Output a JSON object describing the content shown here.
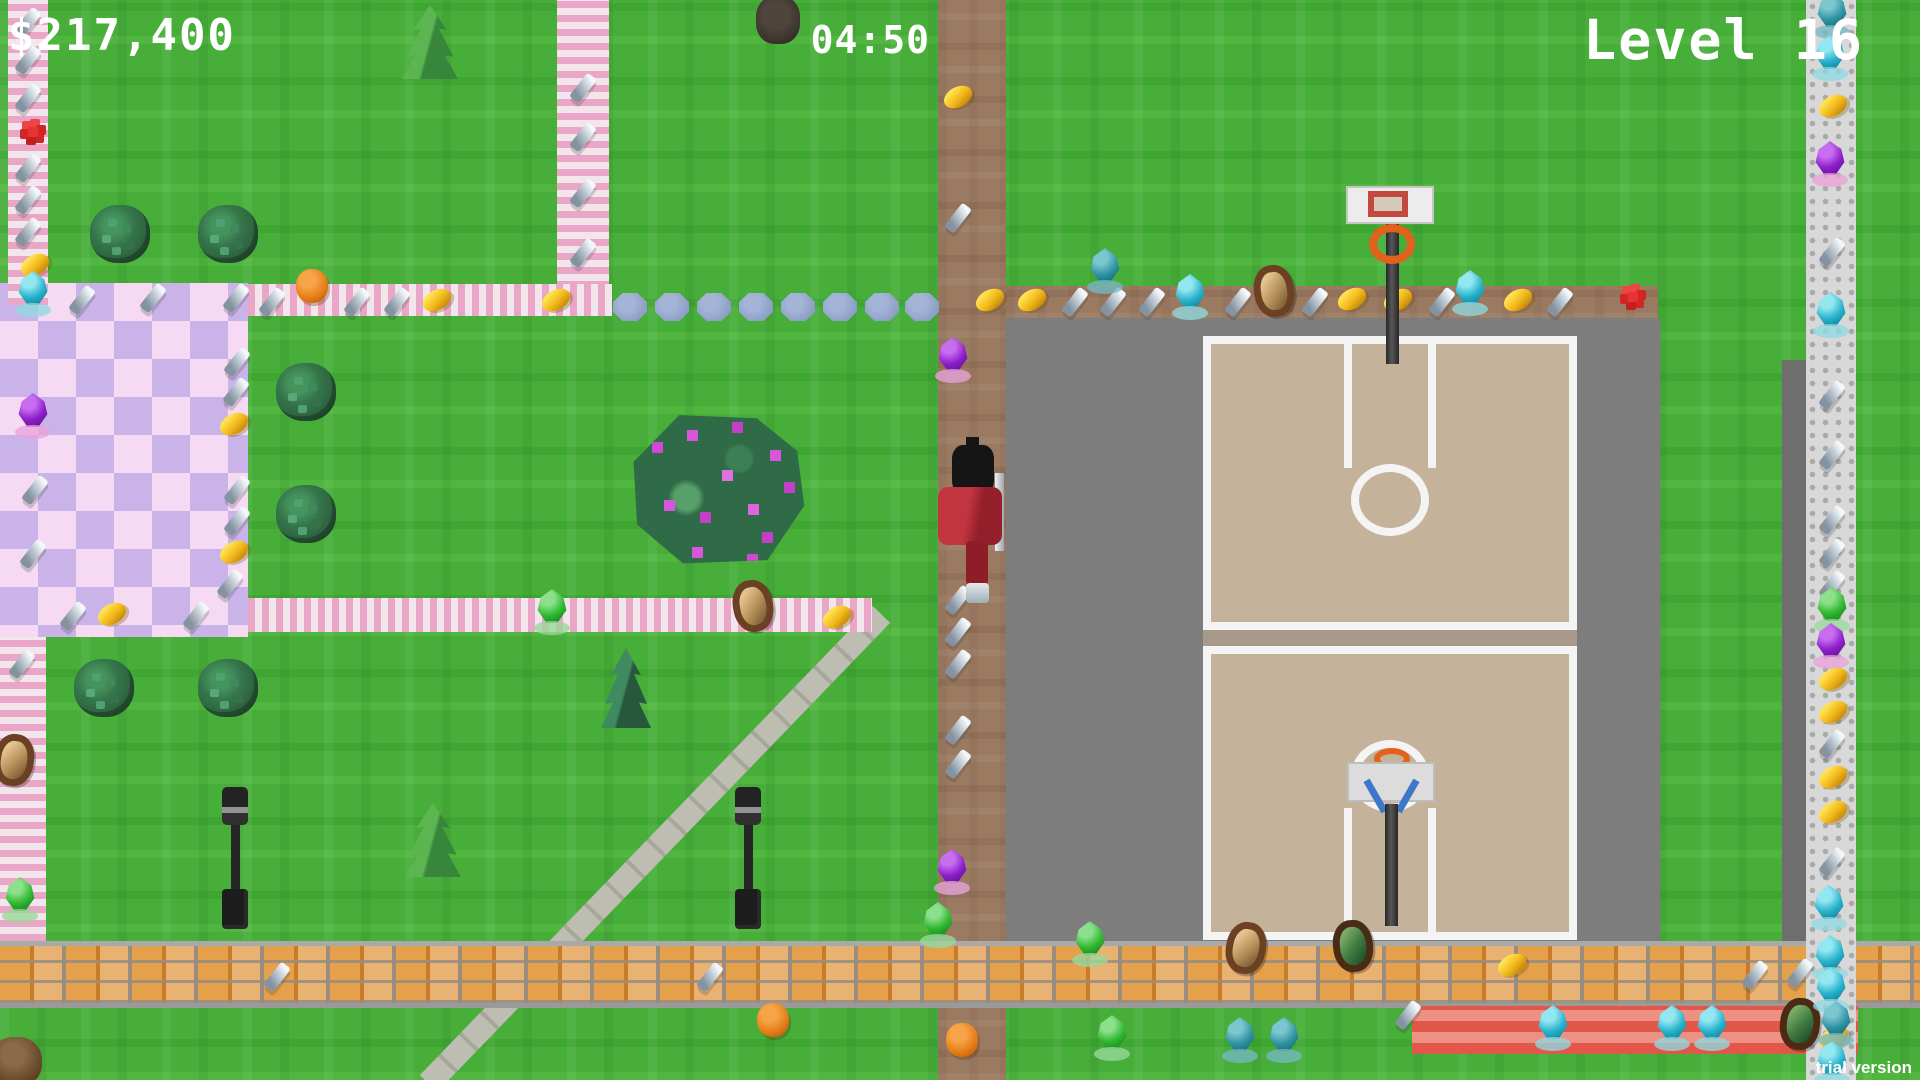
{
  "hud": {
    "money": "$217,400",
    "timer": "04:50",
    "level": "Level 16",
    "trial": "trial version"
  },
  "palette": {
    "grass": "#46ae39",
    "road_brown": "#9b7a62",
    "asphalt": "#7d7d7d",
    "court_beige": "#c5b29a",
    "court_line": "#f4f4f4",
    "brick_orange": "#dd8f3f",
    "red_path": "#e2574a",
    "path_pink": "#eaa6c6",
    "plaza_pink": "#f6d9f3",
    "plaza_lavender": "#c9b3e8",
    "stepping_stone": "#8da0c6",
    "coin_gold": "#f2b91a",
    "gem_cyan": "#27b2cc",
    "gem_purple": "#8d1fc9",
    "gem_green": "#2fb82f",
    "gem_teal": "#2f94a3",
    "screw_gray": "#b9c4ce",
    "player_red": "#b2262f",
    "rim_orange": "#e2611c",
    "hud_text": "#ffffff"
  },
  "scenery": [
    {
      "t": "bush",
      "x": 120,
      "y": 234
    },
    {
      "t": "bush",
      "x": 228,
      "y": 234
    },
    {
      "t": "bush",
      "x": 306,
      "y": 392
    },
    {
      "t": "bush",
      "x": 306,
      "y": 514
    },
    {
      "t": "bush",
      "x": 104,
      "y": 688
    },
    {
      "t": "bush",
      "x": 228,
      "y": 688
    },
    {
      "t": "pine",
      "x": 430,
      "y": 42
    },
    {
      "t": "pine",
      "x": 433,
      "y": 840
    },
    {
      "t": "pine-dark",
      "x": 626,
      "y": 688
    },
    {
      "t": "flower-bush",
      "x": 718,
      "y": 490
    },
    {
      "t": "trunk",
      "x": 778,
      "y": 20
    },
    {
      "t": "trunk-brown",
      "x": 16,
      "y": 1062
    },
    {
      "t": "lamp",
      "x": 235,
      "y": 858
    },
    {
      "t": "lamp",
      "x": 748,
      "y": 858
    },
    {
      "t": "stone",
      "x": 630,
      "y": 307
    },
    {
      "t": "stone",
      "x": 672,
      "y": 307
    },
    {
      "t": "stone",
      "x": 714,
      "y": 307
    },
    {
      "t": "stone",
      "x": 756,
      "y": 307
    },
    {
      "t": "stone",
      "x": 798,
      "y": 307
    },
    {
      "t": "stone",
      "x": 840,
      "y": 307
    },
    {
      "t": "stone",
      "x": 882,
      "y": 307
    },
    {
      "t": "stone",
      "x": 922,
      "y": 307
    }
  ],
  "items": [
    {
      "t": "screw",
      "x": 28,
      "y": 22
    },
    {
      "t": "screw",
      "x": 28,
      "y": 60
    },
    {
      "t": "screw",
      "x": 28,
      "y": 98
    },
    {
      "t": "flower-red",
      "x": 33,
      "y": 132
    },
    {
      "t": "screw",
      "x": 28,
      "y": 168
    },
    {
      "t": "screw",
      "x": 28,
      "y": 200
    },
    {
      "t": "screw",
      "x": 28,
      "y": 232
    },
    {
      "t": "coin",
      "x": 35,
      "y": 265
    },
    {
      "t": "gem-cyan",
      "x": 33,
      "y": 294
    },
    {
      "t": "gem-purple",
      "x": 33,
      "y": 416
    },
    {
      "t": "screw",
      "x": 153,
      "y": 298
    },
    {
      "t": "screw",
      "x": 236,
      "y": 298
    },
    {
      "t": "screw",
      "x": 237,
      "y": 362
    },
    {
      "t": "screw",
      "x": 236,
      "y": 392
    },
    {
      "t": "coin",
      "x": 234,
      "y": 424
    },
    {
      "t": "screw",
      "x": 35,
      "y": 490
    },
    {
      "t": "screw",
      "x": 237,
      "y": 490
    },
    {
      "t": "screw",
      "x": 237,
      "y": 521
    },
    {
      "t": "coin",
      "x": 234,
      "y": 552
    },
    {
      "t": "screw",
      "x": 33,
      "y": 554
    },
    {
      "t": "screw",
      "x": 230,
      "y": 584
    },
    {
      "t": "screw",
      "x": 73,
      "y": 616
    },
    {
      "t": "coin",
      "x": 112,
      "y": 614
    },
    {
      "t": "screw",
      "x": 196,
      "y": 616
    },
    {
      "t": "screw",
      "x": 583,
      "y": 88
    },
    {
      "t": "screw",
      "x": 583,
      "y": 137
    },
    {
      "t": "screw",
      "x": 583,
      "y": 193
    },
    {
      "t": "screw",
      "x": 583,
      "y": 253
    },
    {
      "t": "screw",
      "x": 82,
      "y": 300
    },
    {
      "t": "screw",
      "x": 272,
      "y": 302
    },
    {
      "t": "pumpkin",
      "x": 312,
      "y": 286
    },
    {
      "t": "screw",
      "x": 357,
      "y": 302
    },
    {
      "t": "screw",
      "x": 397,
      "y": 302
    },
    {
      "t": "coin",
      "x": 437,
      "y": 300
    },
    {
      "t": "coin",
      "x": 556,
      "y": 300
    },
    {
      "t": "gem-green",
      "x": 552,
      "y": 612
    },
    {
      "t": "painting-tan",
      "x": 753,
      "y": 606,
      "r": -10
    },
    {
      "t": "coin",
      "x": 837,
      "y": 617
    },
    {
      "t": "screw",
      "x": 22,
      "y": 664
    },
    {
      "t": "painting-tan",
      "x": 14,
      "y": 760,
      "r": 8
    },
    {
      "t": "gem-green",
      "x": 20,
      "y": 900
    },
    {
      "t": "screw",
      "x": 277,
      "y": 977
    },
    {
      "t": "screw",
      "x": 710,
      "y": 977
    },
    {
      "t": "pumpkin",
      "x": 773,
      "y": 1020
    },
    {
      "t": "pumpkin",
      "x": 962,
      "y": 1040
    },
    {
      "t": "coin",
      "x": 958,
      "y": 97
    },
    {
      "t": "screw",
      "x": 958,
      "y": 218
    },
    {
      "t": "gem-purple",
      "x": 953,
      "y": 360
    },
    {
      "t": "screw",
      "x": 958,
      "y": 600
    },
    {
      "t": "screw",
      "x": 958,
      "y": 632
    },
    {
      "t": "screw",
      "x": 958,
      "y": 664
    },
    {
      "t": "screw",
      "x": 958,
      "y": 730
    },
    {
      "t": "screw",
      "x": 958,
      "y": 764
    },
    {
      "t": "gem-purple",
      "x": 952,
      "y": 872
    },
    {
      "t": "gem-green",
      "x": 938,
      "y": 925
    },
    {
      "t": "coin",
      "x": 990,
      "y": 300
    },
    {
      "t": "coin",
      "x": 1032,
      "y": 300
    },
    {
      "t": "screw",
      "x": 1075,
      "y": 302
    },
    {
      "t": "screw",
      "x": 1113,
      "y": 302
    },
    {
      "t": "screw",
      "x": 1152,
      "y": 302
    },
    {
      "t": "gem-cyan",
      "x": 1190,
      "y": 297
    },
    {
      "t": "screw",
      "x": 1238,
      "y": 302
    },
    {
      "t": "painting-tan",
      "x": 1274,
      "y": 291,
      "r": -8
    },
    {
      "t": "screw",
      "x": 1315,
      "y": 302
    },
    {
      "t": "coin",
      "x": 1352,
      "y": 299
    },
    {
      "t": "coin",
      "x": 1398,
      "y": 300
    },
    {
      "t": "screw",
      "x": 1442,
      "y": 302
    },
    {
      "t": "gem-cyan",
      "x": 1470,
      "y": 293
    },
    {
      "t": "coin",
      "x": 1518,
      "y": 300
    },
    {
      "t": "screw",
      "x": 1560,
      "y": 302
    },
    {
      "t": "flower-red",
      "x": 1633,
      "y": 297
    },
    {
      "t": "gem-teal",
      "x": 1105,
      "y": 271
    },
    {
      "t": "gem-green",
      "x": 1090,
      "y": 944
    },
    {
      "t": "painting-tan",
      "x": 1246,
      "y": 948,
      "r": 10
    },
    {
      "t": "painting-green",
      "x": 1353,
      "y": 946,
      "r": -6
    },
    {
      "t": "coin",
      "x": 1512,
      "y": 965
    },
    {
      "t": "screw",
      "x": 1755,
      "y": 975
    },
    {
      "t": "screw",
      "x": 1800,
      "y": 973
    },
    {
      "t": "screw",
      "x": 1408,
      "y": 1015
    },
    {
      "t": "gem-cyan",
      "x": 1553,
      "y": 1028
    },
    {
      "t": "gem-cyan",
      "x": 1672,
      "y": 1028
    },
    {
      "t": "gem-cyan",
      "x": 1712,
      "y": 1028
    },
    {
      "t": "painting-green",
      "x": 1800,
      "y": 1024,
      "r": 6
    },
    {
      "t": "coin",
      "x": 1834,
      "y": 1038
    },
    {
      "t": "gem-green",
      "x": 1112,
      "y": 1038
    },
    {
      "t": "gem-teal",
      "x": 1240,
      "y": 1040
    },
    {
      "t": "gem-teal",
      "x": 1284,
      "y": 1040
    },
    {
      "t": "gem-teal",
      "x": 1832,
      "y": 16
    },
    {
      "t": "gem-cyan",
      "x": 1830,
      "y": 58
    },
    {
      "t": "coin",
      "x": 1833,
      "y": 106
    },
    {
      "t": "gem-purple",
      "x": 1830,
      "y": 164
    },
    {
      "t": "screw",
      "x": 1832,
      "y": 252
    },
    {
      "t": "gem-cyan",
      "x": 1831,
      "y": 315
    },
    {
      "t": "screw",
      "x": 1832,
      "y": 395
    },
    {
      "t": "screw",
      "x": 1832,
      "y": 455
    },
    {
      "t": "screw",
      "x": 1832,
      "y": 520
    },
    {
      "t": "screw",
      "x": 1832,
      "y": 553
    },
    {
      "t": "screw",
      "x": 1832,
      "y": 585
    },
    {
      "t": "gem-green",
      "x": 1832,
      "y": 610
    },
    {
      "t": "gem-purple",
      "x": 1831,
      "y": 646
    },
    {
      "t": "coin",
      "x": 1833,
      "y": 679
    },
    {
      "t": "coin",
      "x": 1833,
      "y": 712
    },
    {
      "t": "screw",
      "x": 1832,
      "y": 744
    },
    {
      "t": "coin",
      "x": 1833,
      "y": 777
    },
    {
      "t": "coin",
      "x": 1833,
      "y": 812
    },
    {
      "t": "screw",
      "x": 1832,
      "y": 862
    },
    {
      "t": "gem-cyan",
      "x": 1829,
      "y": 908
    },
    {
      "t": "gem-cyan",
      "x": 1830,
      "y": 958
    },
    {
      "t": "gem-cyan",
      "x": 1831,
      "y": 990
    },
    {
      "t": "gem-teal",
      "x": 1836,
      "y": 1024
    },
    {
      "t": "gem-cyan",
      "x": 1832,
      "y": 1064
    }
  ]
}
